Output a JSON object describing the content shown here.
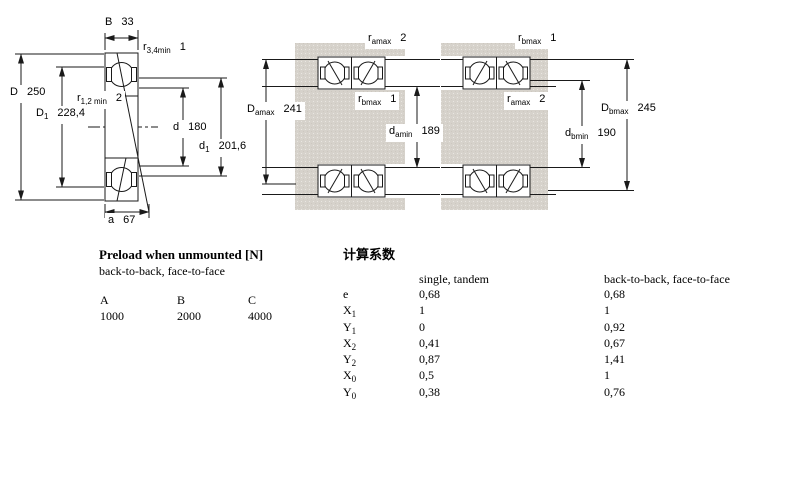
{
  "drawing_left": {
    "dims": {
      "B": {
        "sym": "B",
        "sub": "",
        "value": "33"
      },
      "r34": {
        "sym": "r",
        "sub": "3,4min",
        "value": "1"
      },
      "D": {
        "sym": "D",
        "sub": "",
        "value": "250"
      },
      "r12": {
        "sym": "r",
        "sub": "1,2 min",
        "value": "2"
      },
      "D1": {
        "sym": "D",
        "sub": "1",
        "value": "228,4"
      },
      "d": {
        "sym": "d",
        "sub": "",
        "value": "180"
      },
      "d1": {
        "sym": "d",
        "sub": "1",
        "value": "201,6"
      },
      "a": {
        "sym": "a",
        "sub": "",
        "value": "67"
      }
    }
  },
  "drawing_mid": {
    "dims": {
      "ra": {
        "sym": "r",
        "sub": "amax",
        "value": "2"
      },
      "rb": {
        "sym": "r",
        "sub": "bmax",
        "value": "1"
      },
      "Da": {
        "sym": "D",
        "sub": "amax",
        "value": "241"
      },
      "da": {
        "sym": "d",
        "sub": "amin",
        "value": "189"
      }
    }
  },
  "drawing_right": {
    "dims": {
      "rb": {
        "sym": "r",
        "sub": "bmax",
        "value": "1"
      },
      "ra": {
        "sym": "r",
        "sub": "amax",
        "value": "2"
      },
      "Db": {
        "sym": "D",
        "sub": "bmax",
        "value": "245"
      },
      "db": {
        "sym": "d",
        "sub": "bmin",
        "value": "190"
      }
    }
  },
  "preload_table": {
    "title": "Preload when unmounted [N]",
    "subtitle": "back-to-back, face-to-face",
    "columns": [
      "A",
      "B",
      "C"
    ],
    "values": [
      "1000",
      "2000",
      "4000"
    ]
  },
  "factors_table": {
    "title": "计算系数",
    "col1_header": "single, tandem",
    "col2_header": "back-to-back, face-to-face",
    "rows": [
      {
        "sym": "e",
        "sub": "",
        "v1": "0,68",
        "v2": "0,68"
      },
      {
        "sym": "X",
        "sub": "1",
        "v1": "1",
        "v2": "1"
      },
      {
        "sym": "Y",
        "sub": "1",
        "v1": "0",
        "v2": "0,92"
      },
      {
        "sym": "X",
        "sub": "2",
        "v1": "0,41",
        "v2": "0,67"
      },
      {
        "sym": "Y",
        "sub": "2",
        "v1": "0,87",
        "v2": "1,41"
      },
      {
        "sym": "X",
        "sub": "0",
        "v1": "0,5",
        "v2": "1"
      },
      {
        "sym": "Y",
        "sub": "0",
        "v1": "0,38",
        "v2": "0,76"
      }
    ]
  },
  "colors": {
    "ring_blue": "#b9c8e1",
    "metal_gray": "#d6d2cb",
    "line": "#1a1a1a",
    "background": "#ffffff"
  }
}
